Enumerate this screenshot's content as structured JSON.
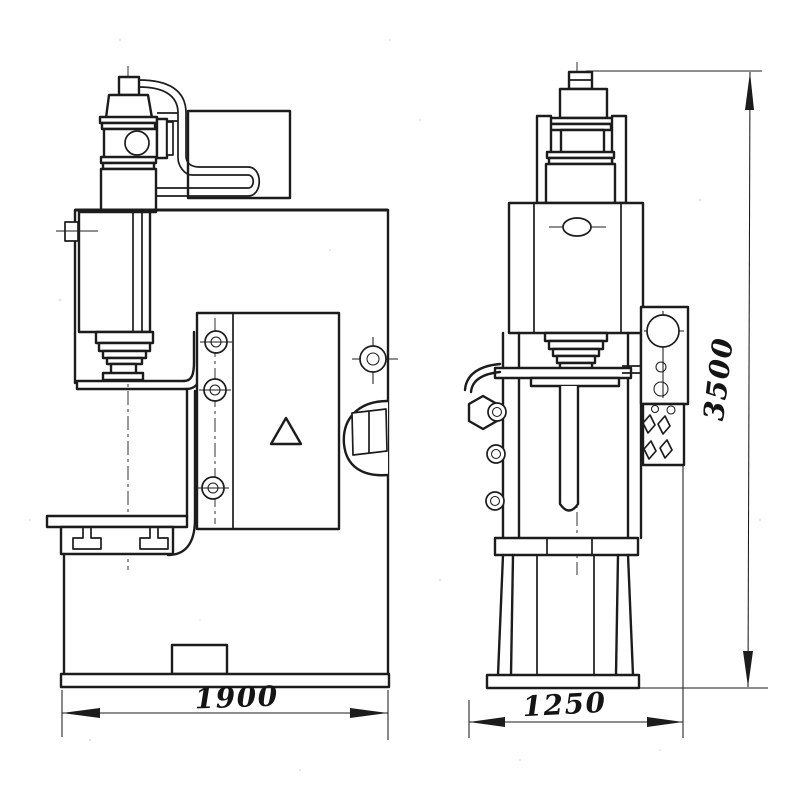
{
  "drawing": {
    "kind": "two-view machine outline drawing",
    "background": "#ffffff",
    "line_color": "#1c1c1c"
  },
  "dimensions": {
    "front_width": "1900",
    "side_width": "1250",
    "overall_height": "3500"
  }
}
